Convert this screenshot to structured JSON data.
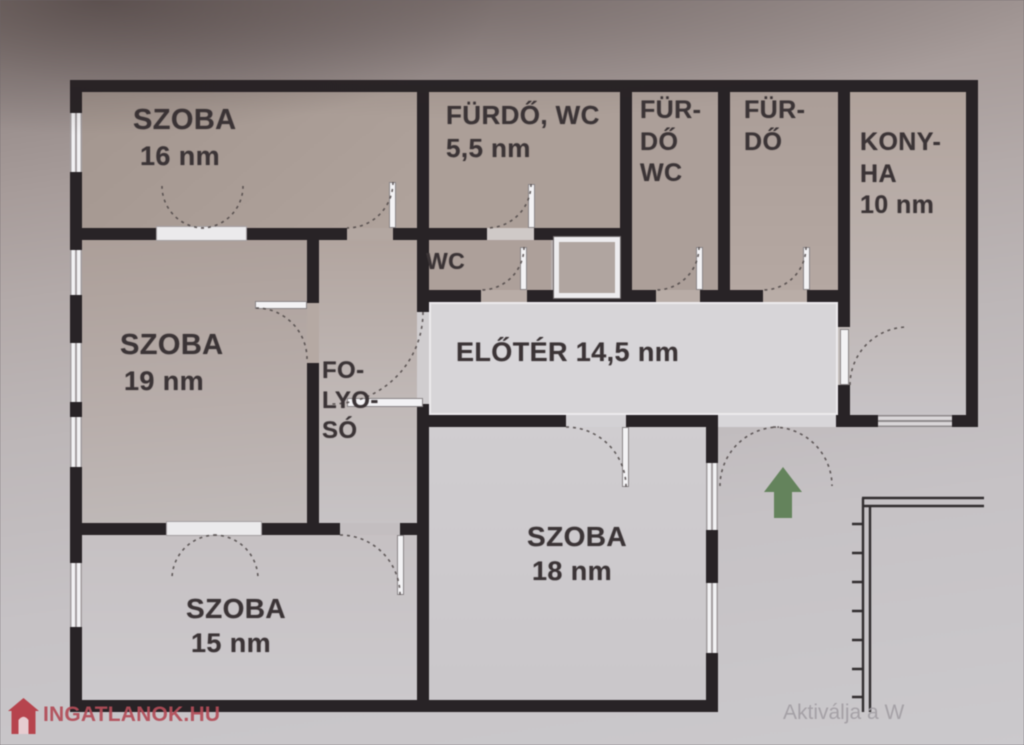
{
  "plan": {
    "rooms": {
      "szoba16": {
        "name": "SZOBA",
        "area": "16 nm"
      },
      "furdo_wc": {
        "name": "FÜRDŐ, WC",
        "area": "5,5 nm"
      },
      "furdo_wc_kis": {
        "line1": "FÜR-",
        "line2": "DŐ",
        "line3": "WC"
      },
      "furdo_kis": {
        "line1": "FÜR-",
        "line2": "DŐ"
      },
      "konyha": {
        "line1": "KONY-",
        "line2": "HA",
        "line3": "10 nm"
      },
      "szoba19": {
        "name": "SZOBA",
        "area": "19 nm"
      },
      "folyoso": {
        "line1": "FO-",
        "line2": "LYO-",
        "line3": "SÓ"
      },
      "wc": {
        "name": "WC"
      },
      "eloter": {
        "label": "ELŐTÉR 14,5 nm"
      },
      "szoba18": {
        "name": "SZOBA",
        "area": "18 nm"
      },
      "szoba15": {
        "name": "SZOBA",
        "area": "15 nm"
      }
    },
    "colors": {
      "wall": "#282326",
      "entrance_arrow": "#5f7f56",
      "eloter_floor": "#d7d5d8"
    }
  },
  "branding": {
    "site": "INGATLANOK.HU",
    "logo_red": "#b53b44"
  },
  "overlay": {
    "os_activation": "Aktiválja a W"
  }
}
